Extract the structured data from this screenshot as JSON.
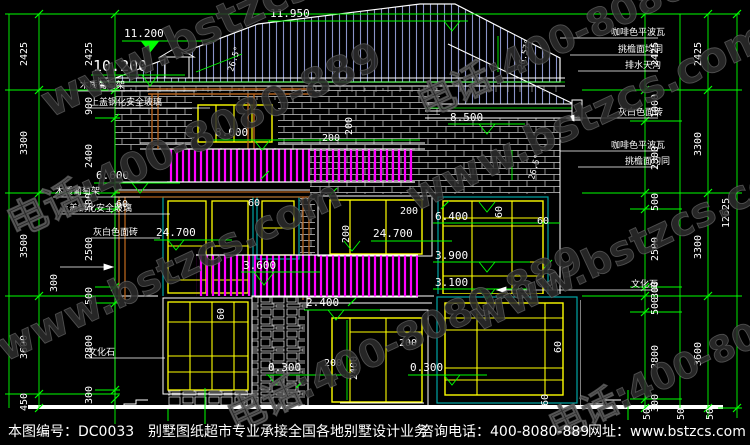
{
  "title": "别墅正立面施工图",
  "colors": {
    "dimension_green": "#00ff00",
    "window_frame_yellow": "#ffff00",
    "railing_magenta": "#ff00ff",
    "window_border_teal": "#00a5a5",
    "roof_hatch_blue": "#8a93c8",
    "wood_orange": "#b4621d",
    "line_white": "#ffffff",
    "background": "#000000"
  },
  "watermark": {
    "site": "www.bstzcs.com",
    "phone": "电话:400-8080-889"
  },
  "footer": {
    "drawing_no": "本图编号：DC0033",
    "slogan": "别墅图纸超市专业承接全国各地别墅设计业务",
    "phone": "咨询电话：400-8080-889",
    "website": "网址：www.bstzcs.com"
  },
  "levels": [
    "11.950",
    "11.200",
    "10.200",
    "8.500",
    "8.000",
    "6.600",
    "24.700",
    "24.700",
    "6.400",
    "3.900",
    "3.600",
    "3.100",
    "2.400",
    "0.300",
    "0.300"
  ],
  "dims": {
    "left_outer": [
      "2425",
      "3300",
      "3500",
      "3600",
      "450"
    ],
    "left_inner": [
      "2425",
      "900",
      "2400",
      "500",
      "2500",
      "500",
      "2800",
      "300"
    ],
    "left_extra": [
      "300"
    ],
    "right_inner": [
      "2425",
      "1000",
      "2300",
      "500",
      "2500",
      "300",
      "500",
      "2800",
      "300"
    ],
    "right_middle": [
      "2425",
      "3300",
      "3300",
      "3600"
    ],
    "right_total": "12625",
    "right_ground": [
      "50",
      "50",
      "50"
    ],
    "opening": [
      "200",
      "200",
      "200",
      "200",
      "200",
      "200",
      "2400",
      "60",
      "60",
      "60",
      "60",
      "60",
      "60",
      "60"
    ]
  },
  "angles": [
    "26.5°",
    "26.57°",
    "26.5°"
  ],
  "notes_left": [
    "木质葡萄架",
    "上盖钢化安全玻璃",
    "木质葡萄架",
    "上盖钢化安全玻璃",
    "灰白色面砖",
    "文化石"
  ],
  "notes_right": [
    "咖啡色平波瓦",
    "挑檐面均同",
    "排水天沟",
    "灰白色面砖",
    "咖啡色平波瓦",
    "挑檐面均同",
    "文化石"
  ]
}
